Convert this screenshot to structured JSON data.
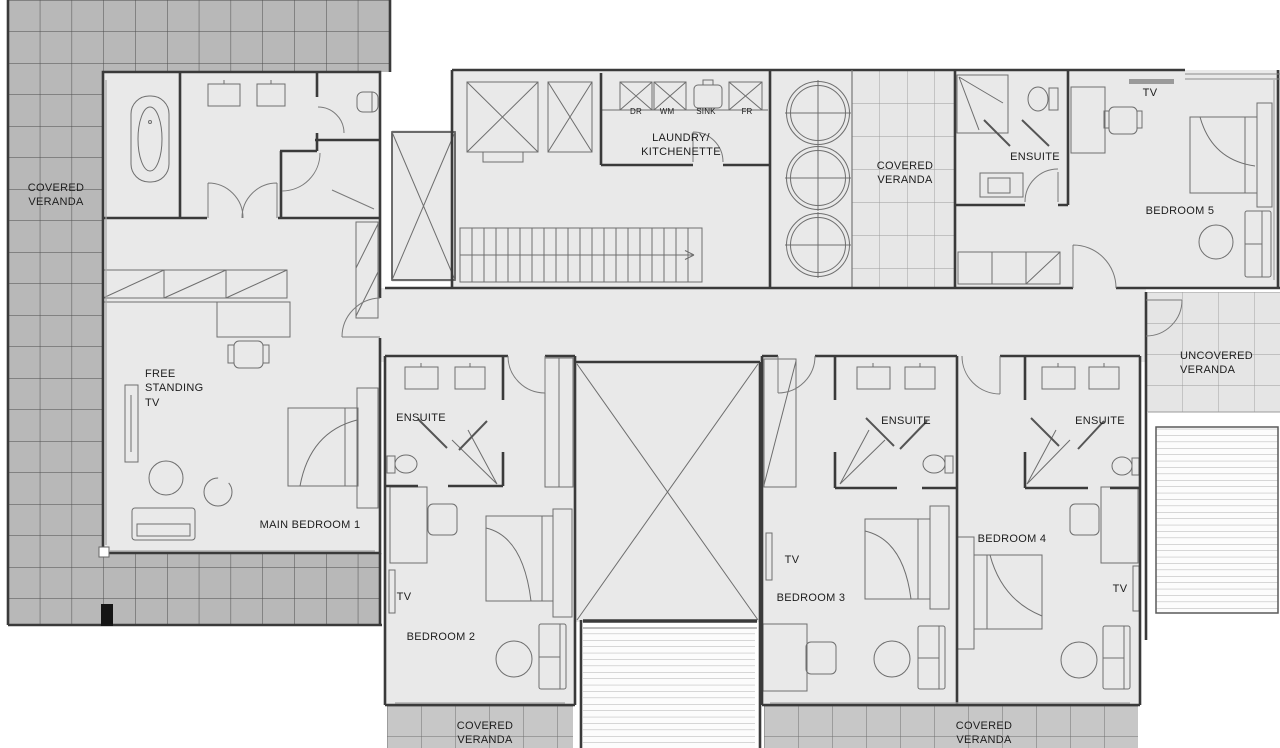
{
  "drawing": {
    "kind": "residential upper floor plan",
    "colors": {
      "interior_fill": "#e9e9e9",
      "veranda_dark_tile": "#b8b8b8",
      "veranda_medium_tile": "#c7c7c7",
      "veranda_light_grid": "#e7e7e7",
      "wall_line": "#3a3a3a",
      "furniture_line": "#6e6e6e",
      "text": "#1d1d1d"
    }
  },
  "rooms": {
    "main_bedroom_1": {
      "label": "MAIN BEDROOM 1",
      "tv": "FREE\nSTANDING\nTV"
    },
    "bedroom_2": {
      "label": "BEDROOM 2",
      "ensuite": "ENSUITE",
      "tv": "TV"
    },
    "bedroom_3": {
      "label": "BEDROOM 3",
      "ensuite": "ENSUITE",
      "tv": "TV"
    },
    "bedroom_4": {
      "label": "BEDROOM 4",
      "ensuite": "ENSUITE",
      "tv": "TV"
    },
    "bedroom_5": {
      "label": "BEDROOM 5",
      "ensuite": "ENSUITE",
      "tv": "TV"
    },
    "laundry_kitchenette": {
      "label": "LAUNDRY/\nKITCHENETTE",
      "appliances": [
        "DR",
        "WM",
        "SINK",
        "FR"
      ]
    }
  },
  "verandas": {
    "top_left": "COVERED\nVERANDA",
    "middle": "COVERED\nVERANDA",
    "bottom_left": "COVERED\nVERANDA",
    "bottom_right": "COVERED\nVERANDA",
    "uncovered": "UNCOVERED\nVERANDA"
  }
}
